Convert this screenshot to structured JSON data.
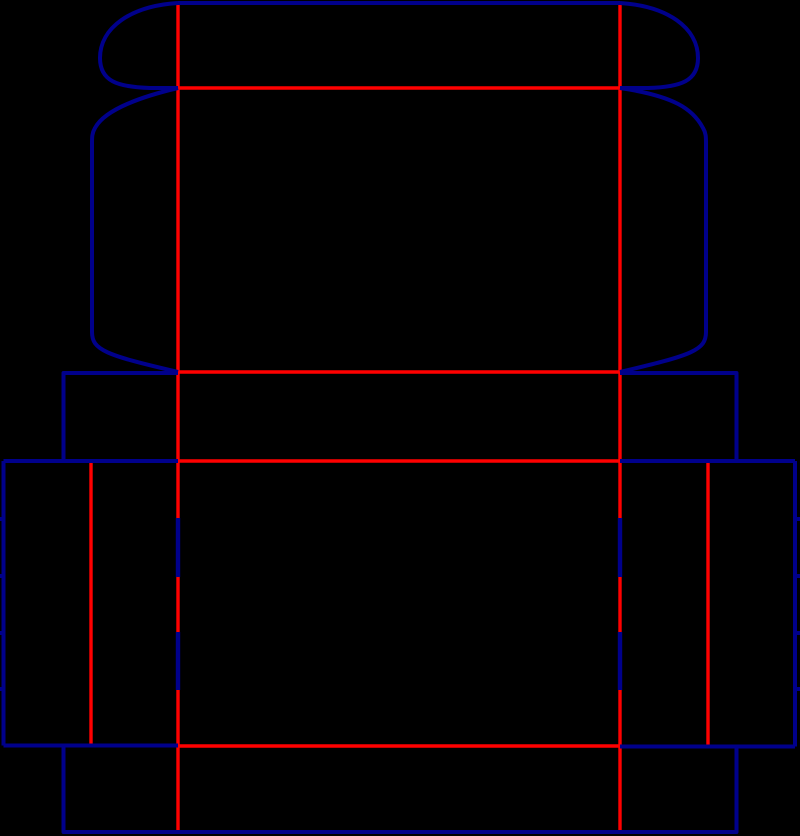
{
  "diagram": {
    "type": "packaging-dieline",
    "description": "Die-cut template (dieline) of a tuck-top folding carton box on a black background. Navy lines are cut edges, red lines are crease/fold lines, short navy dashes over the red folds are perforations.",
    "canvas": {
      "width": 800,
      "height": 836,
      "background": "#000000"
    },
    "colors": {
      "cut": "#00008B",
      "crease": "#FF0000",
      "background": "#000000"
    },
    "legend": [
      {
        "style": "solid navy",
        "meaning": "cut line"
      },
      {
        "style": "solid red",
        "meaning": "crease / fold line"
      },
      {
        "style": "navy dash over red",
        "meaning": "perforation segment"
      }
    ],
    "cut_lines": [
      {
        "name": "lid-tuck-top-edge",
        "d": "M 178 3 H 620"
      },
      {
        "name": "lid-tuck-left-ear",
        "d": "M 178 3 C 130 6 100 28 100 58 C 100 81 117 87 150 88 L 178 88"
      },
      {
        "name": "lid-tuck-right-ear",
        "d": "M 620 3 C 668 6 698 28 698 58 C 698 81 681 87 648 88 L 620 88"
      },
      {
        "name": "lid-left-wing-edge",
        "d": "M 178 88 C 144 96 105 109 95 128 C 92 133 92 137 92 144 L 92 332 C 92 350 105 355 178 372"
      },
      {
        "name": "lid-right-wing-edge",
        "d": "M 620 88 C 674 96 693 109 703 128 C 706 133 706 137 706 144 L 706 332 C 706 350 693 355 620 372"
      },
      {
        "name": "collar-left-edge",
        "d": "M 178 373 H 63.5 V 461"
      },
      {
        "name": "collar-right-edge",
        "d": "M 620 373 H 736.5 V 461"
      },
      {
        "name": "body-top-cut-left",
        "d": "M 3.5 461 H 178"
      },
      {
        "name": "body-top-cut-right",
        "d": "M 620 461 H 795"
      },
      {
        "name": "left-outer-edge",
        "d": "M 3.5 461 V 745.5"
      },
      {
        "name": "right-outer-edge",
        "d": "M 795 461 V 746.5"
      },
      {
        "name": "left-edge-notches",
        "d": "M 0 519 H 5 M 0 576 H 5 M 0 633 H 5 M 0 689 H 5"
      },
      {
        "name": "right-edge-notches",
        "d": "M 795 519 H 800 M 795 576 H 800 M 795 633 H 800 M 795 689 H 800"
      },
      {
        "name": "left-bottom-cut",
        "d": "M 3.5 745.5 H 178"
      },
      {
        "name": "right-bottom-cut",
        "d": "M 620 746.5 H 795"
      },
      {
        "name": "bottom-flap-outline",
        "d": "M 63.5 745.5 V 832 H 736.5 V 746.5"
      }
    ],
    "crease_lines": [
      {
        "name": "main-fold-left",
        "d": "M 178 3 V 832"
      },
      {
        "name": "main-fold-right",
        "d": "M 620 3 V 832"
      },
      {
        "name": "tuck-flap-crease",
        "d": "M 178 88 H 620"
      },
      {
        "name": "lid-collar-crease",
        "d": "M 178 372 H 620"
      },
      {
        "name": "collar-body-crease",
        "d": "M 178 461 H 620"
      },
      {
        "name": "body-bottom-crease",
        "d": "M 178 746 H 620"
      },
      {
        "name": "left-flap-crease",
        "d": "M 91 462 V 744"
      },
      {
        "name": "right-flap-crease",
        "d": "M 708 462 V 746"
      }
    ],
    "perforation_overlays": [
      {
        "name": "perf-left-upper",
        "d": "M 178 518 V 577"
      },
      {
        "name": "perf-left-lower",
        "d": "M 178 632 V 690"
      },
      {
        "name": "perf-right-upper",
        "d": "M 620 518 V 577"
      },
      {
        "name": "perf-right-lower",
        "d": "M 620 632 V 690"
      }
    ]
  }
}
